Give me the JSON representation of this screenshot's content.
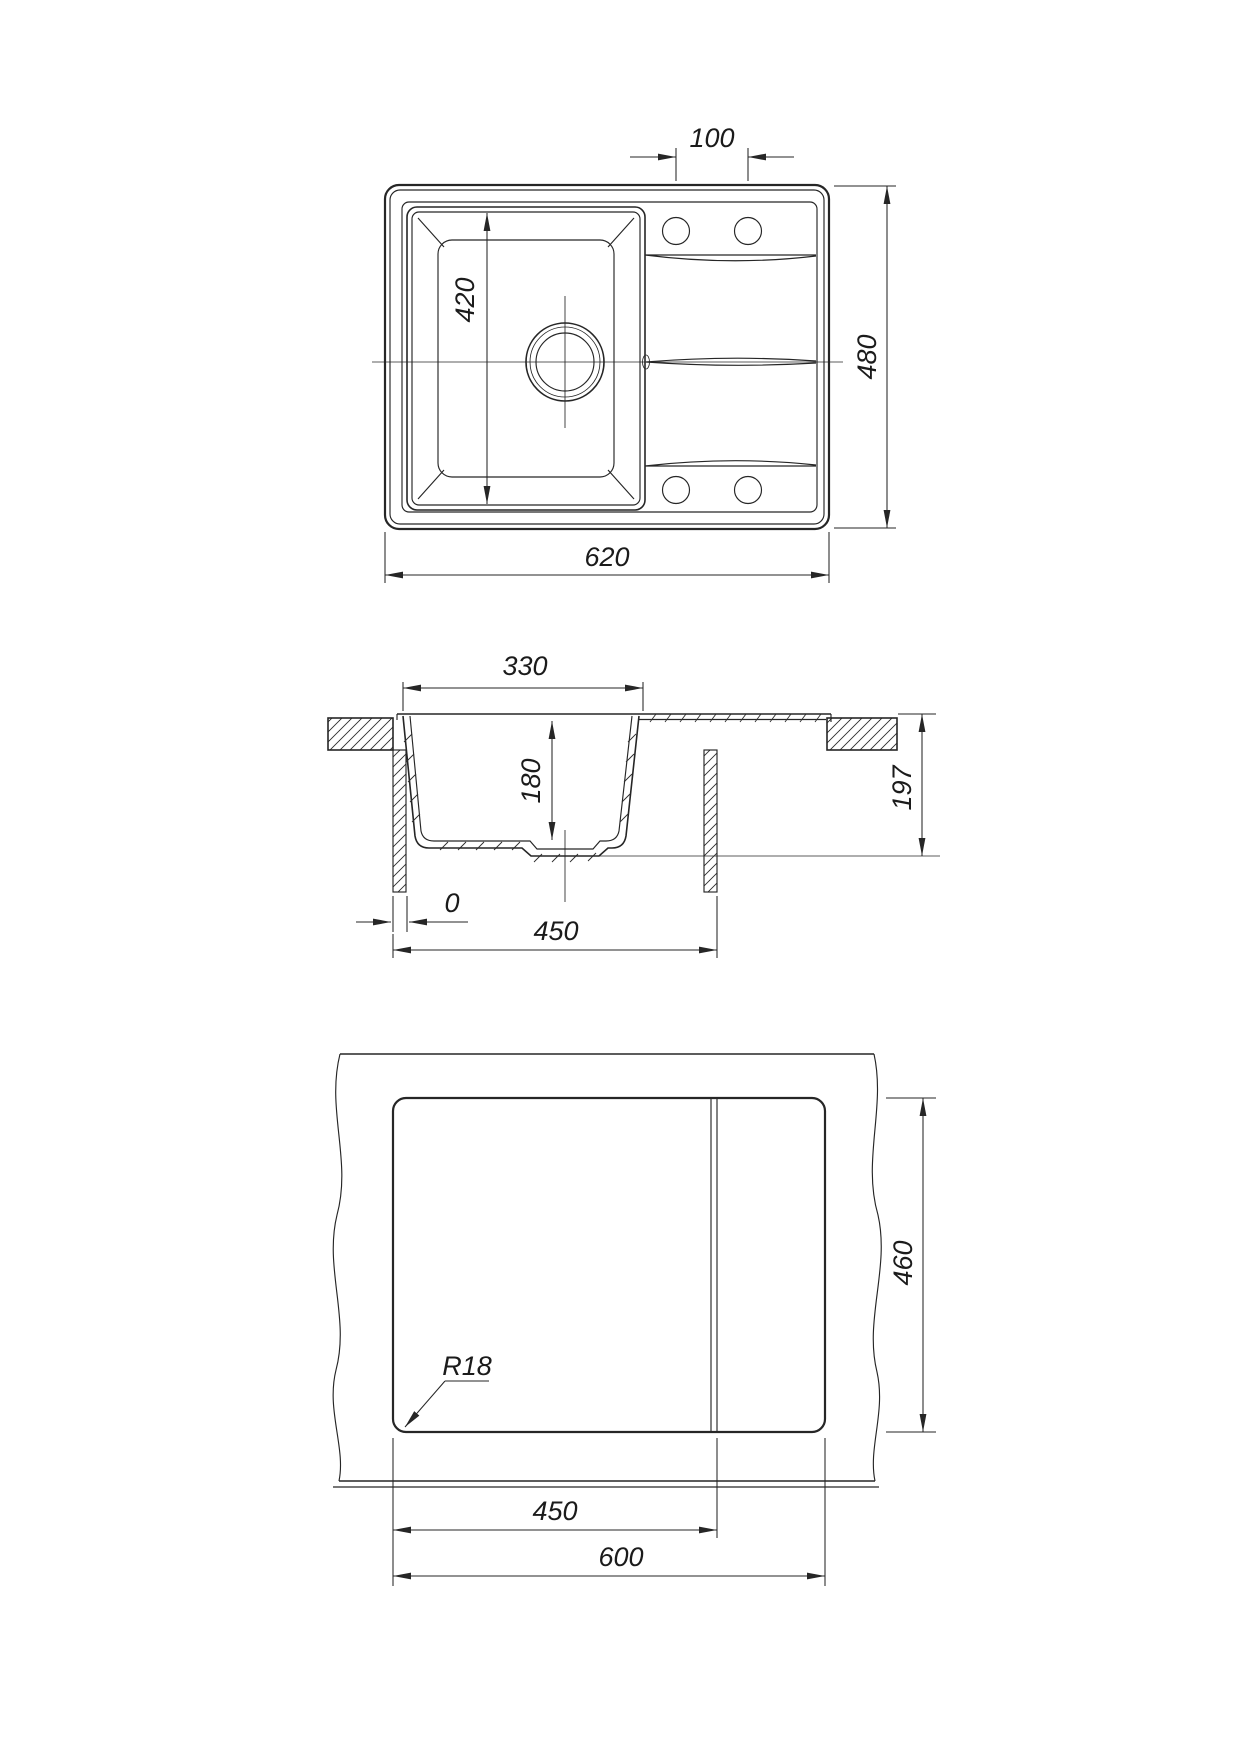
{
  "drawing": {
    "background": "#ffffff",
    "line_color": "#262626",
    "views": {
      "plan": {
        "hole_spacing": "100",
        "overall_height": "480",
        "overall_width": "620",
        "bowl_length": "420"
      },
      "section": {
        "bowl_top_width": "330",
        "bowl_depth": "180",
        "total_height": "197",
        "edge_offset": "0",
        "base_width": "450"
      },
      "cutout": {
        "corner_radius": "R18",
        "cut_depth": "460",
        "cut_left_width": "450",
        "cut_full_width": "600"
      }
    }
  }
}
